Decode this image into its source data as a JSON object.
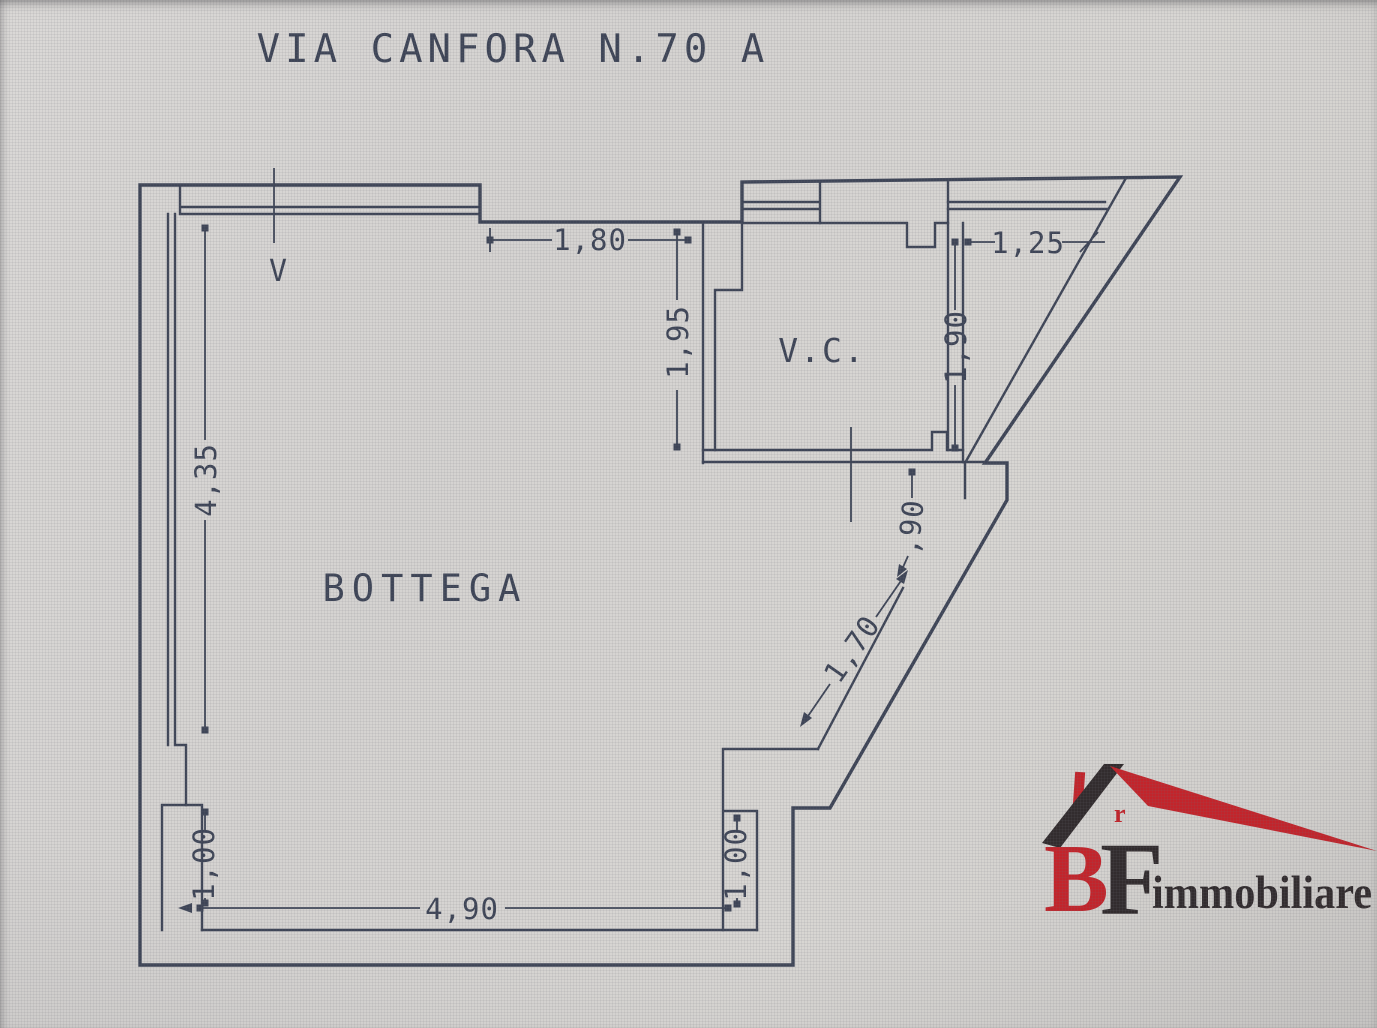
{
  "header": {
    "title": "VIA CANFORA N.70 A"
  },
  "plan": {
    "main_room_label": "BOTTEGA",
    "wc_label": "V.C.",
    "vent_label": "V",
    "dimensions": {
      "top_window": "1,80",
      "top_right": "1,25",
      "wc_left": "1,95",
      "wc_right": "1,90",
      "entrance_door": ",90",
      "diagonal_wall": "1,70",
      "left_wall": "4,35",
      "left_pier": "1,00",
      "bottom_wall": "4,90",
      "bottom_pier": "1,00"
    }
  },
  "logo": {
    "letter_b": "B",
    "letter_f": "F",
    "wordmark": "immobiliare",
    "roof_mark": "r"
  },
  "colors": {
    "wall": "#3e4557",
    "logo_red": "#c3242b",
    "logo_dark": "#322c2e",
    "background": "#d5d3d1"
  }
}
